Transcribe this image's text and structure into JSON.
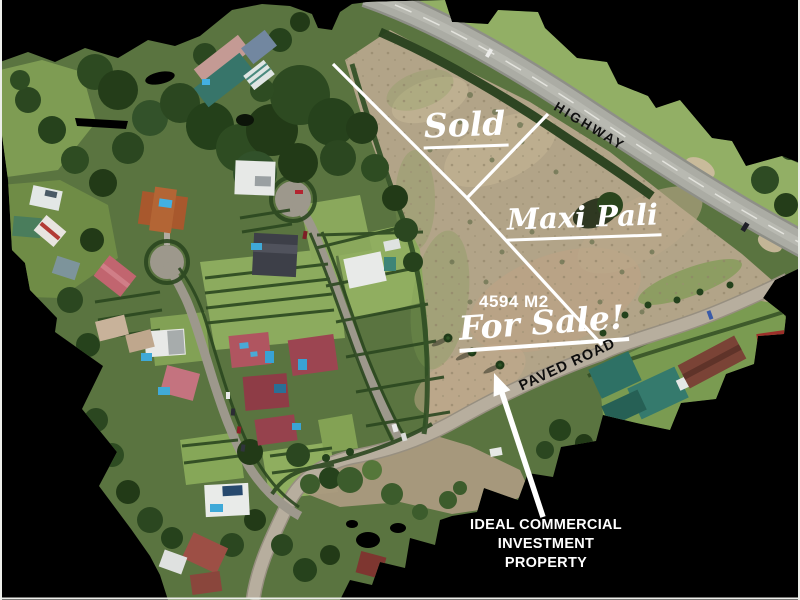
{
  "labels": {
    "sold": "Sold",
    "highway": "HIGHWAY",
    "store": "Maxi Pali",
    "area": "4594 M2",
    "for_sale": "For Sale!",
    "paved_road": "PAVED ROAD",
    "note_line1": "IDEAL COMMERCIAL",
    "note_line2": "INVESTMENT",
    "note_line3": "PROPERTY"
  },
  "colors": {
    "background": "#000000",
    "annotation_white": "#ffffff",
    "road_label_black": "#0d0d0d",
    "dirt_lot": "#b2a488",
    "grass": "#5a7440"
  }
}
